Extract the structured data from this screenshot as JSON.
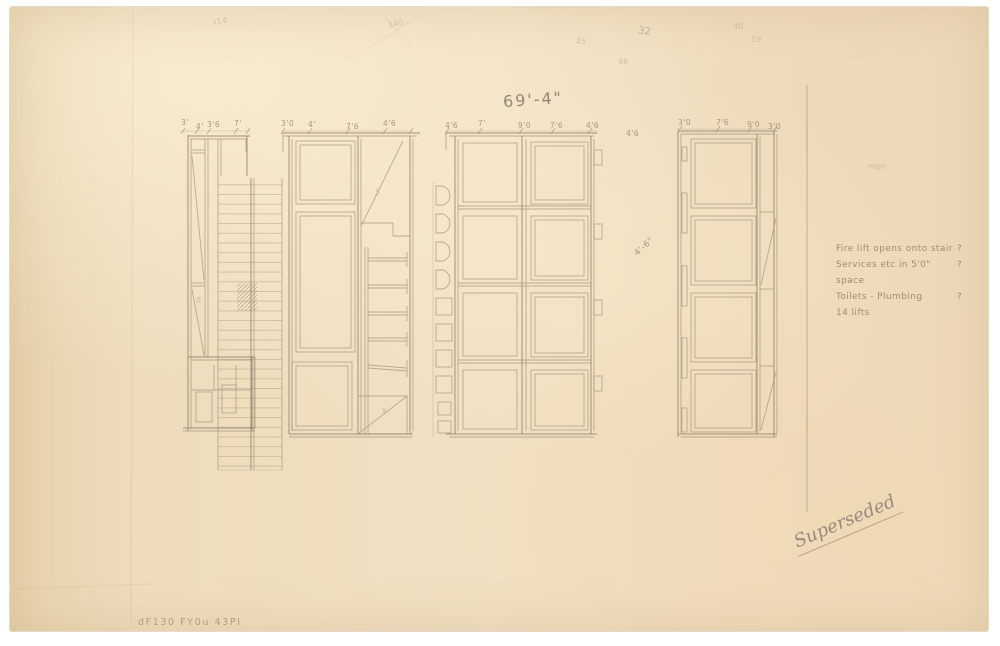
{
  "sheet": {
    "overall_dimension": "69'-4\"",
    "notes": [
      {
        "text": "Fire lift opens onto stair",
        "mark": "?"
      },
      {
        "text": "Services etc in 5'0\" space",
        "mark": "?"
      },
      {
        "text": "Toilets - Plumbing",
        "mark": "?"
      },
      {
        "text": "14 lifts",
        "mark": ""
      }
    ],
    "stamp": "Superseded",
    "inscription": "dF130 FY0u 43PI",
    "dims": {
      "b1": [
        "3'",
        "4'",
        "3'6",
        "7'"
      ],
      "b2": [
        "3'0",
        "4'",
        "7'6",
        "4'6"
      ],
      "b3": [
        "4'6",
        "7'",
        "9'0",
        "7'6",
        "4'6"
      ],
      "b4": [
        "3'0",
        "7'6",
        "9'0",
        "3'0"
      ],
      "gap_top": "4'6",
      "gap_mid": "4'-6\""
    },
    "scribbles": {
      "s_x14": "x14",
      "s_140": "140",
      "s_45": "45",
      "s_32": "32",
      "s_40": "40",
      "s_1d": "1d",
      "s_46": "46",
      "s_mph": "mph",
      "s_8": "8",
      "s_x": "x",
      "s_5": "5"
    },
    "colors": {
      "paper": "#eedcbc",
      "pencil": "#a6967f",
      "graphite": "#8f8170"
    }
  }
}
